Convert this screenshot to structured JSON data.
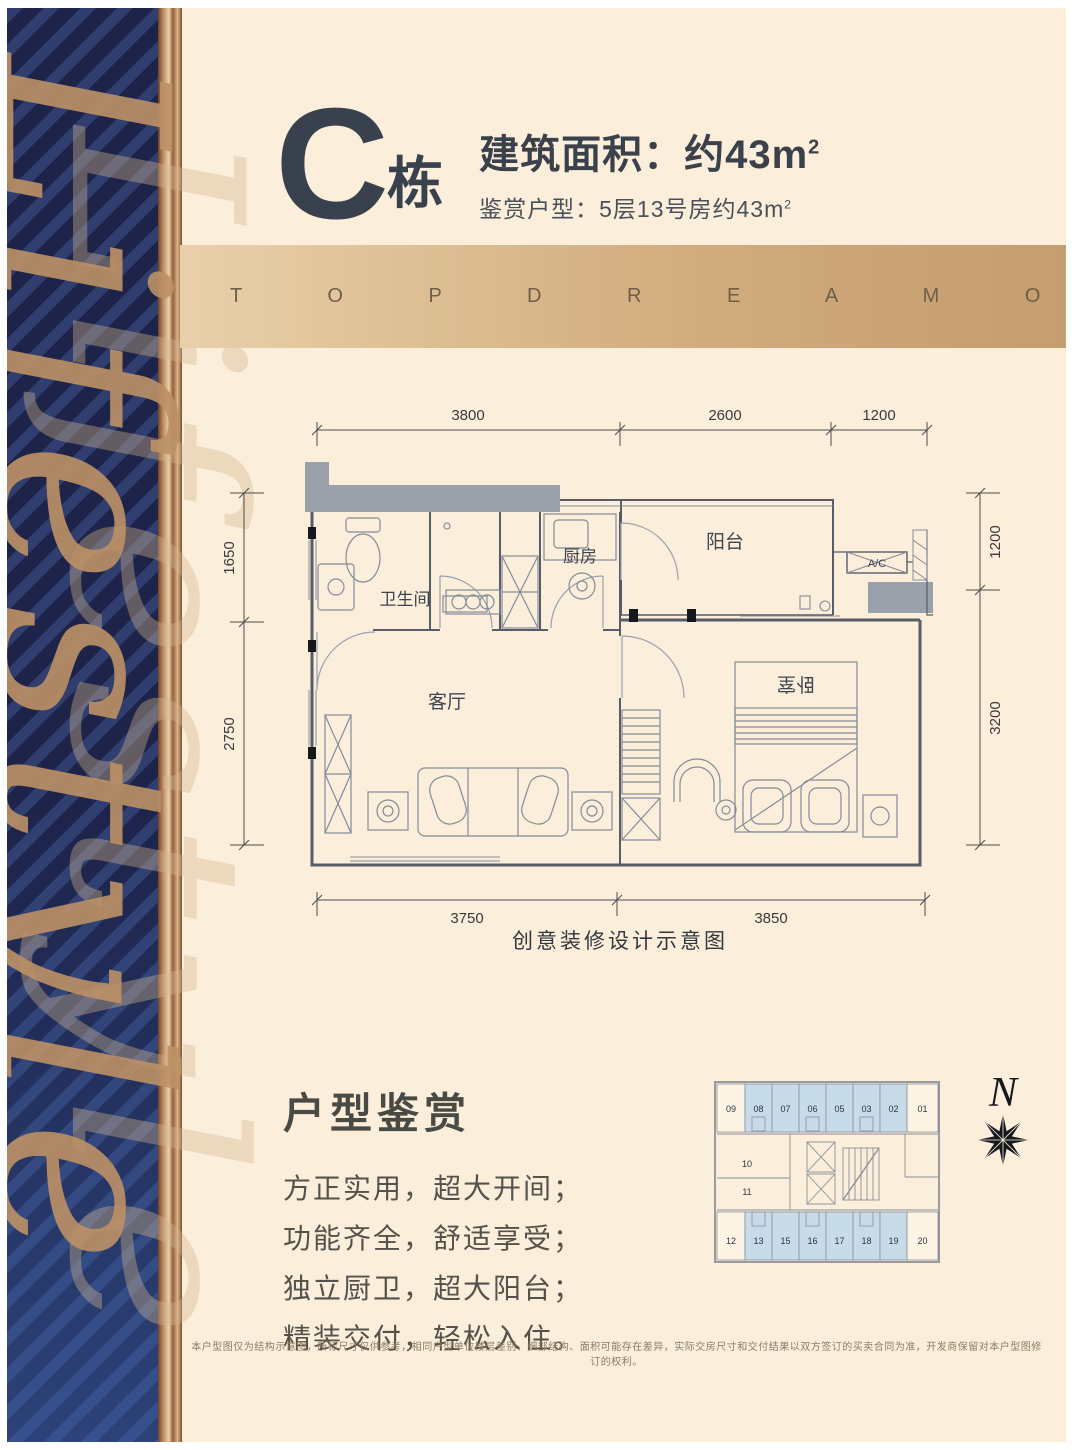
{
  "decor": {
    "script_text": "Lifestyle"
  },
  "header": {
    "building_letter": "C",
    "building_suffix": "栋",
    "area_label": "建筑面积：约43m",
    "area_superscript": "2",
    "subtitle": "鉴赏户型：5层13号房约43m",
    "subtitle_superscript": "2"
  },
  "banner": {
    "text": "T O P D R E A M O F C I T Y"
  },
  "floor_plan": {
    "caption": "创意装修设计示意图",
    "rooms": {
      "bathroom": "卫生间",
      "kitchen": "厨房",
      "balcony": "阳台",
      "living": "客厅",
      "bedroom": "卧室",
      "ac": "A/C"
    },
    "dimensions": {
      "top": [
        "3800",
        "2600",
        "1200"
      ],
      "left": [
        "1650",
        "2750"
      ],
      "right": [
        "1200",
        "3200"
      ],
      "bottom": [
        "3750",
        "3850"
      ]
    }
  },
  "appreciation": {
    "heading": "户型鉴赏",
    "lines": [
      "方正实用，超大开间；",
      "功能齐全，舒适享受；",
      "独立厨卫，超大阳台；",
      "精装交付，轻松入住。"
    ]
  },
  "key_plan": {
    "top_units": [
      "09",
      "08",
      "07",
      "06",
      "05",
      "03",
      "02",
      "01"
    ],
    "middle_units": [
      "10",
      "11"
    ],
    "bottom_units": [
      "12",
      "13",
      "15",
      "16",
      "17",
      "18",
      "19",
      "20"
    ],
    "compass_label": "N"
  },
  "disclaimer": "本户型图仅为结构示意图，所标尺寸仅供参考，相同户型单位楼层差别、细部结构、面积可能存在差异，实际交房尺寸和交付结果以双方签订的买卖合同为准，开发商保留对本户型图修订的权利。"
}
